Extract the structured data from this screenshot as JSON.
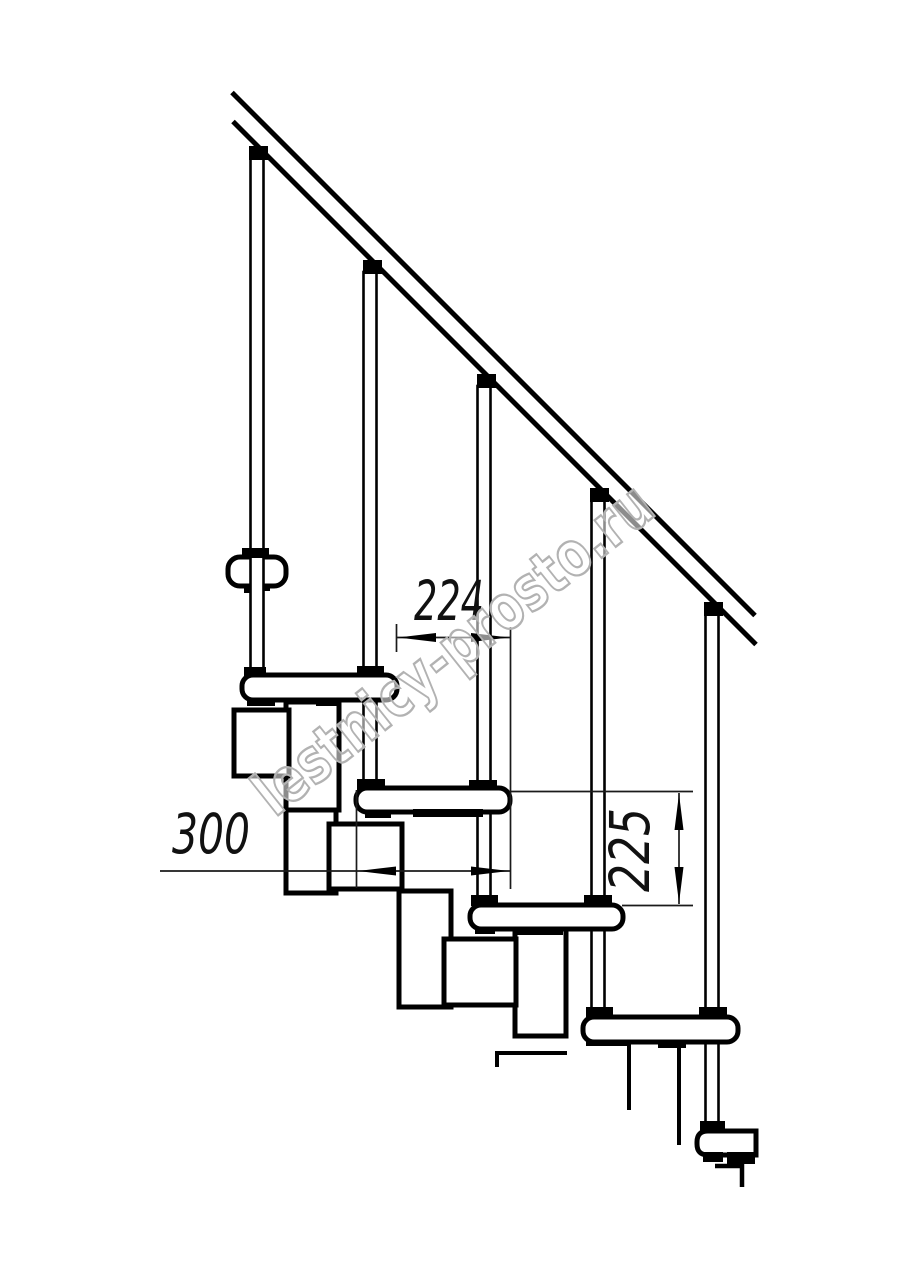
{
  "drawing": {
    "background": "#ffffff",
    "line_color": "#000000",
    "dimension_color": "#1a1a1a",
    "treads_visible": 6,
    "balusters_visible": 5,
    "dimension_labels": {
      "run": "224",
      "depth": "300",
      "rise": "225"
    }
  },
  "watermark": {
    "text": "lestnicy-prosto.ru",
    "color": "#b2b2b2"
  }
}
